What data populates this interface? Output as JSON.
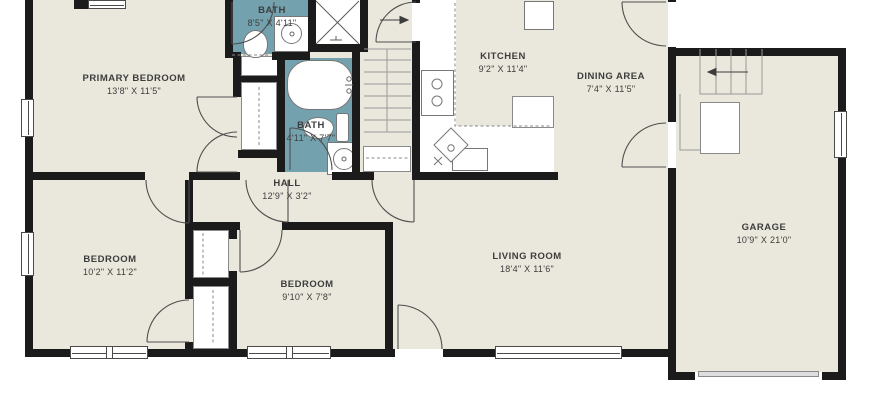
{
  "colors": {
    "floor": "#eae7dc",
    "bathroom_floor": "#73a1ad",
    "wall": "#1b1b1b",
    "fixture_outline": "#8a8a8a",
    "label_text": "#3d3d3d",
    "garage_door": "#dedede"
  },
  "rooms": [
    {
      "id": "primary-bedroom",
      "name": "PRIMARY BEDROOM",
      "dims": "13'8\" X 11'5\""
    },
    {
      "id": "bath-1",
      "name": "BATH",
      "dims": "8'5\" X 4'11\""
    },
    {
      "id": "kitchen",
      "name": "KITCHEN",
      "dims": "9'2\" X 11'4\""
    },
    {
      "id": "dining-area",
      "name": "DINING AREA",
      "dims": "7'4\" X 11'5\""
    },
    {
      "id": "bath-2",
      "name": "BATH",
      "dims": "4'11\" X 7'7\""
    },
    {
      "id": "hall",
      "name": "HALL",
      "dims": "12'9\" X 3'2\""
    },
    {
      "id": "bedroom-1",
      "name": "BEDROOM",
      "dims": "10'2\" X 11'2\""
    },
    {
      "id": "bedroom-2",
      "name": "BEDROOM",
      "dims": "9'10\" X 7'8\""
    },
    {
      "id": "living-room",
      "name": "LIVING ROOM",
      "dims": "18'4\" X 11'6\""
    },
    {
      "id": "garage",
      "name": "GARAGE",
      "dims": "10'9\" X 21'0\""
    }
  ],
  "fixtures": [
    "bathtub",
    "shower",
    "toilet",
    "sink",
    "stove",
    "refrigerator",
    "staircase",
    "closet-rod",
    "garage-door",
    "window",
    "door-swing"
  ]
}
